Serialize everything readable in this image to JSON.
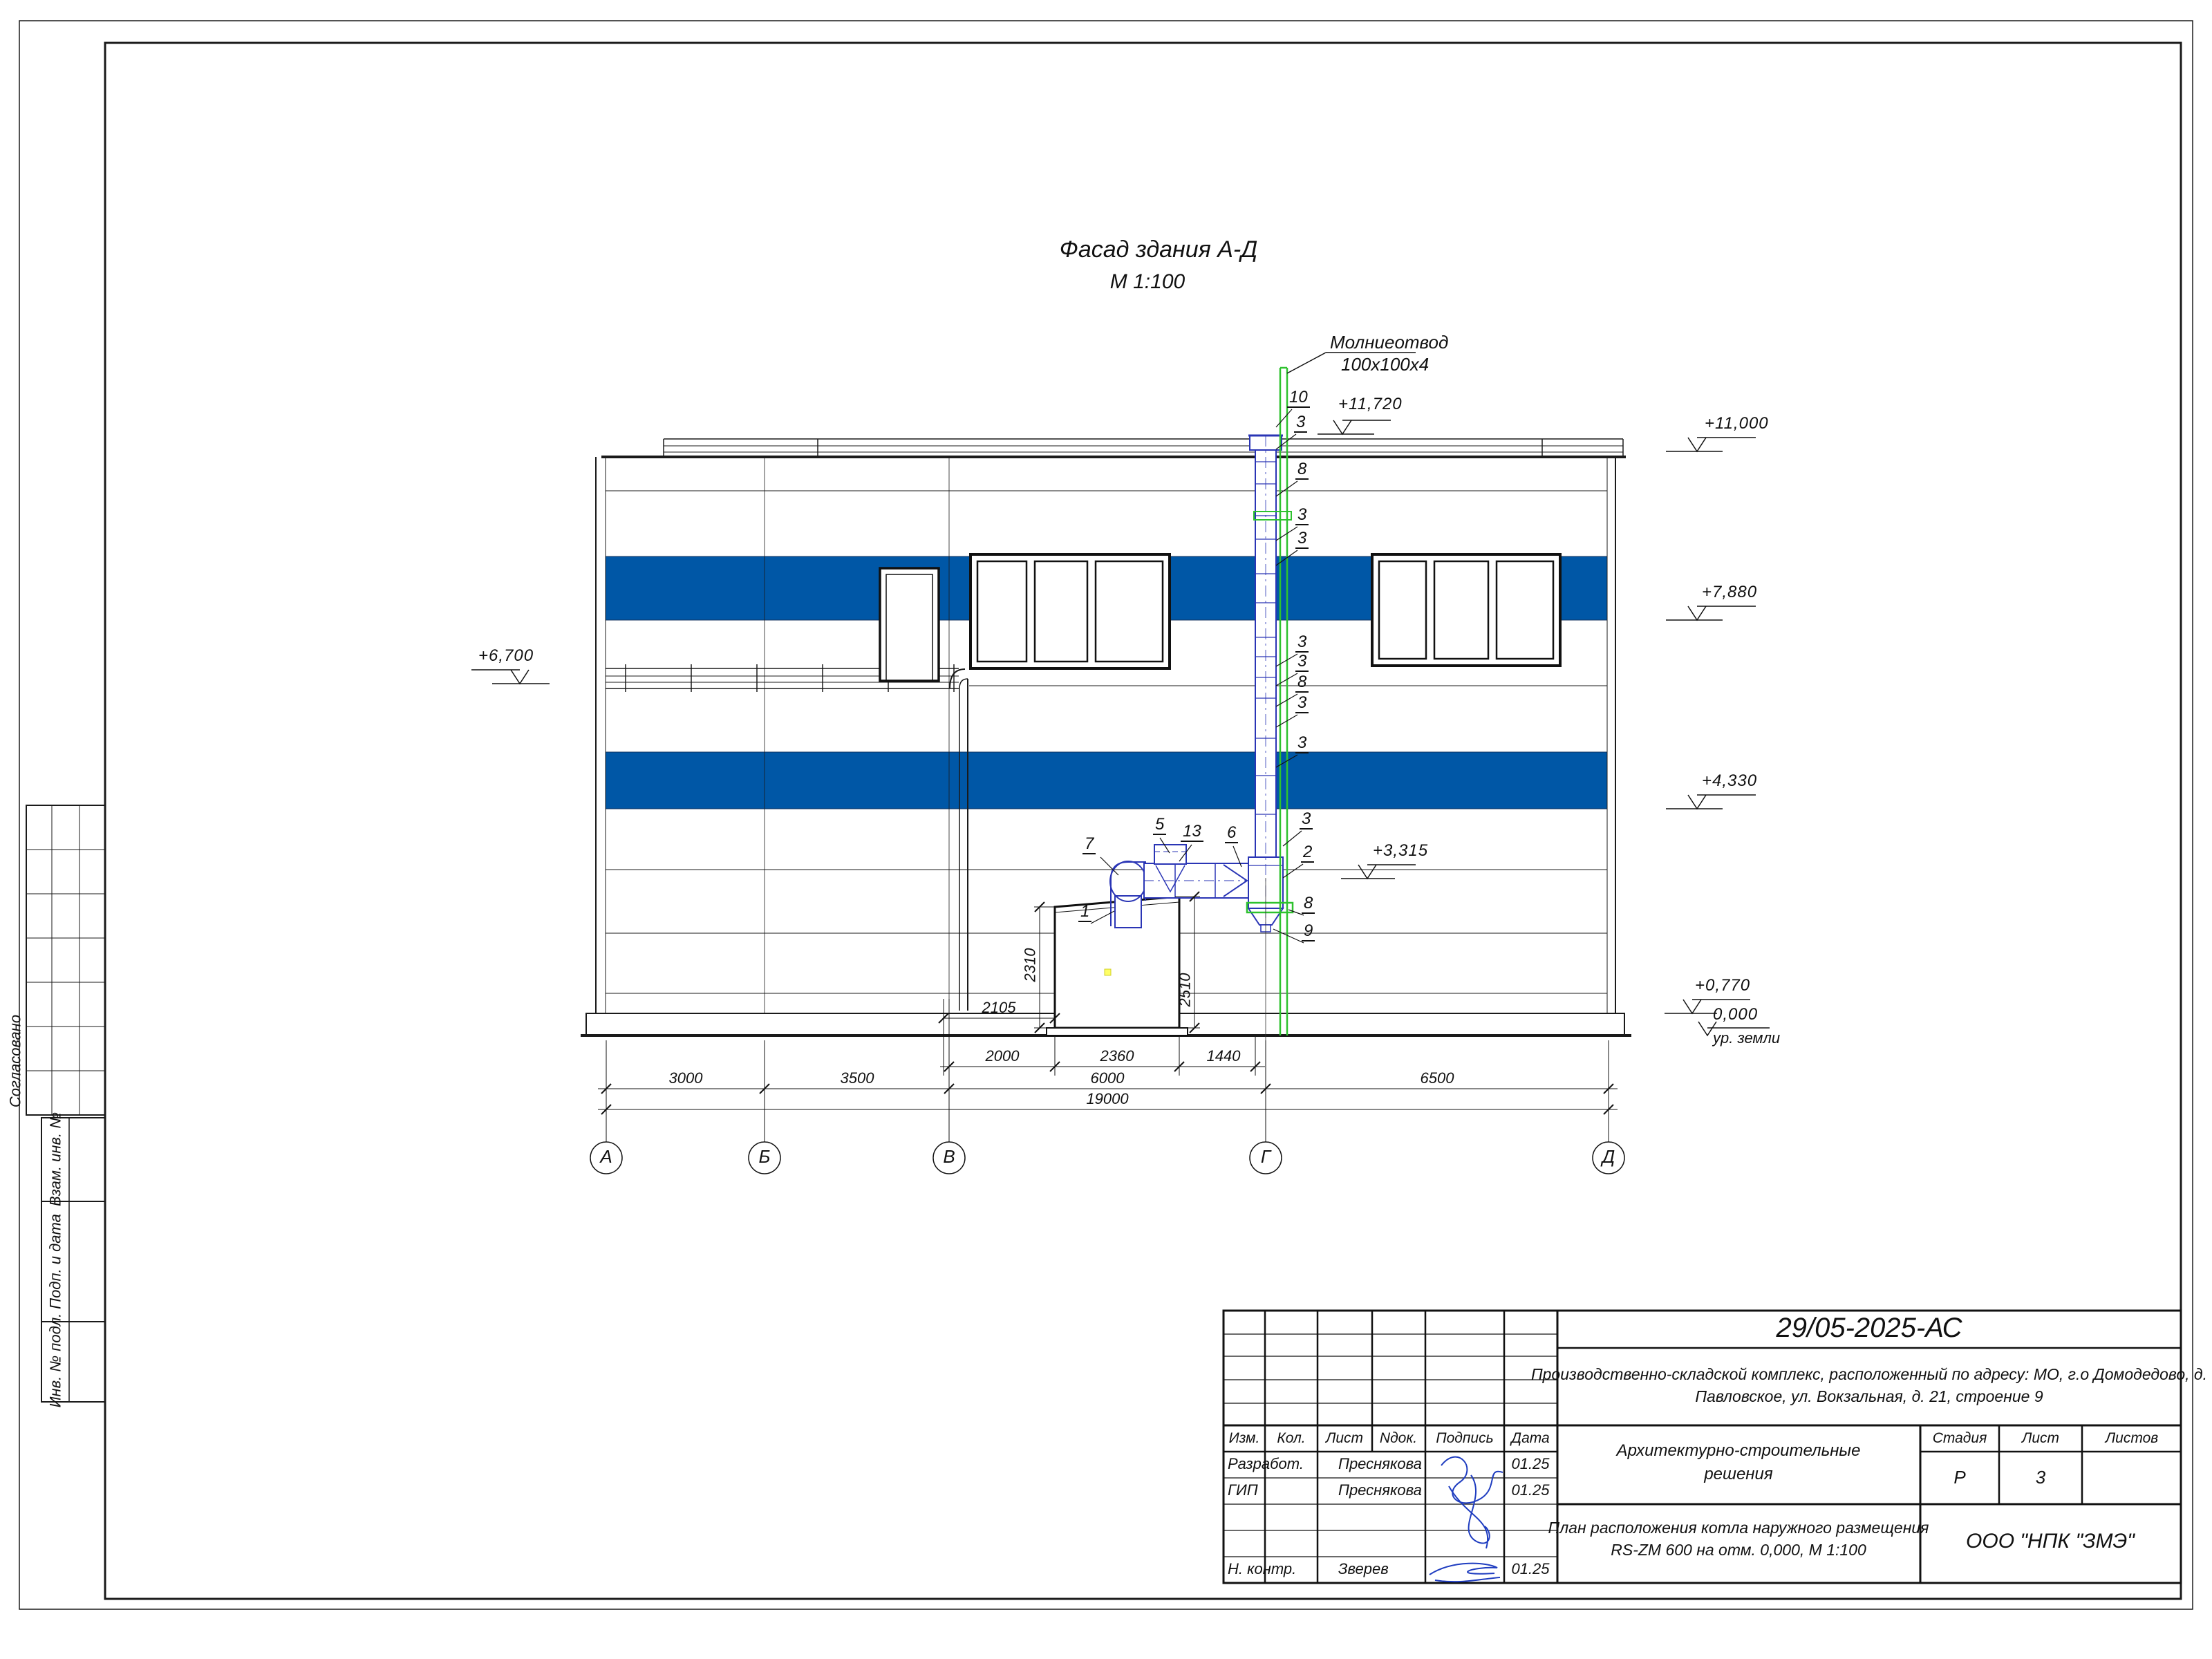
{
  "sheet": {
    "accent_blue": "#0057a6",
    "flue_blue": "#2a35b5",
    "rod_green": "#2ec22e",
    "signature_blue": "#1f3dc0"
  },
  "title": {
    "line1": "Фасад здания А-Д",
    "line2": "М 1:100"
  },
  "annotations": {
    "lightning_line1": "Молниеотвод",
    "lightning_line2": "100х100х4",
    "ground_level_label": "ур. земли"
  },
  "elevations": {
    "top_chimney": "+11,720",
    "roof": "+11,000",
    "stripe1": "+7,880",
    "annex_roof": "+6,700",
    "stripe2": "+4,330",
    "duct_axis": "+3,315",
    "plinth": "+0,770",
    "zero": "0,000"
  },
  "callouts": {
    "c10": "10",
    "c3a": "3",
    "c8a": "8",
    "c3b": "3",
    "c3c": "3",
    "c3d": "3",
    "c3e": "3",
    "c8b": "8",
    "c3f": "3",
    "c3g": "3",
    "c3h": "3",
    "c2": "2",
    "c8c": "8",
    "c9": "9",
    "c5": "5",
    "c13": "13",
    "c6": "6",
    "c7": "7",
    "c1": "1"
  },
  "dimensions": {
    "v2310": "2310",
    "v2510": "2510",
    "h2105": "2105",
    "h2000": "2000",
    "h2360": "2360",
    "h1440": "1440",
    "h3000": "3000",
    "h3500": "3500",
    "h6000": "6000",
    "h6500": "6500",
    "h19000": "19000"
  },
  "axes": {
    "a": "А",
    "b": "Б",
    "v": "В",
    "g": "Г",
    "d": "Д"
  },
  "sidebar": {
    "approved": "Согласовано",
    "vzam": "Взам. инв. №",
    "podp": "Подп. и дата",
    "inv": "Инв. № подл."
  },
  "titleblock": {
    "doc_number": "29/05-2025-АС",
    "project_line1": "Производственно-складской комплекс, расположенный по адресу: МО, г.о Домодедово, д.",
    "project_line2": "Павловское, ул. Вокзальная, д. 21, строение 9",
    "headers": {
      "izm": "Изм.",
      "kol": "Кол.",
      "list": "Лист",
      "ndok": "Nдок.",
      "podpis": "Подпись",
      "data": "Дата"
    },
    "rows": [
      {
        "role": "Разработ.",
        "name": "Преснякова",
        "date": "01.25"
      },
      {
        "role": "ГИП",
        "name": "Преснякова",
        "date": "01.25"
      },
      {
        "role": "Н. контр.",
        "name": "Зверев",
        "date": "01.25"
      }
    ],
    "section_title1": "Архитектурно-строительные",
    "section_title2": "решения",
    "stage_header": {
      "stadia": "Стадия",
      "list": "Лист",
      "listov": "Листов"
    },
    "stage_values": {
      "stadia": "Р",
      "list": "3"
    },
    "sheet_title1": "План расположения котла наружного размещения",
    "sheet_title2": "RS-ZM 600 на отм. 0,000,  М 1:100",
    "company": "ООО \"НПК \"ЗМЭ\""
  }
}
